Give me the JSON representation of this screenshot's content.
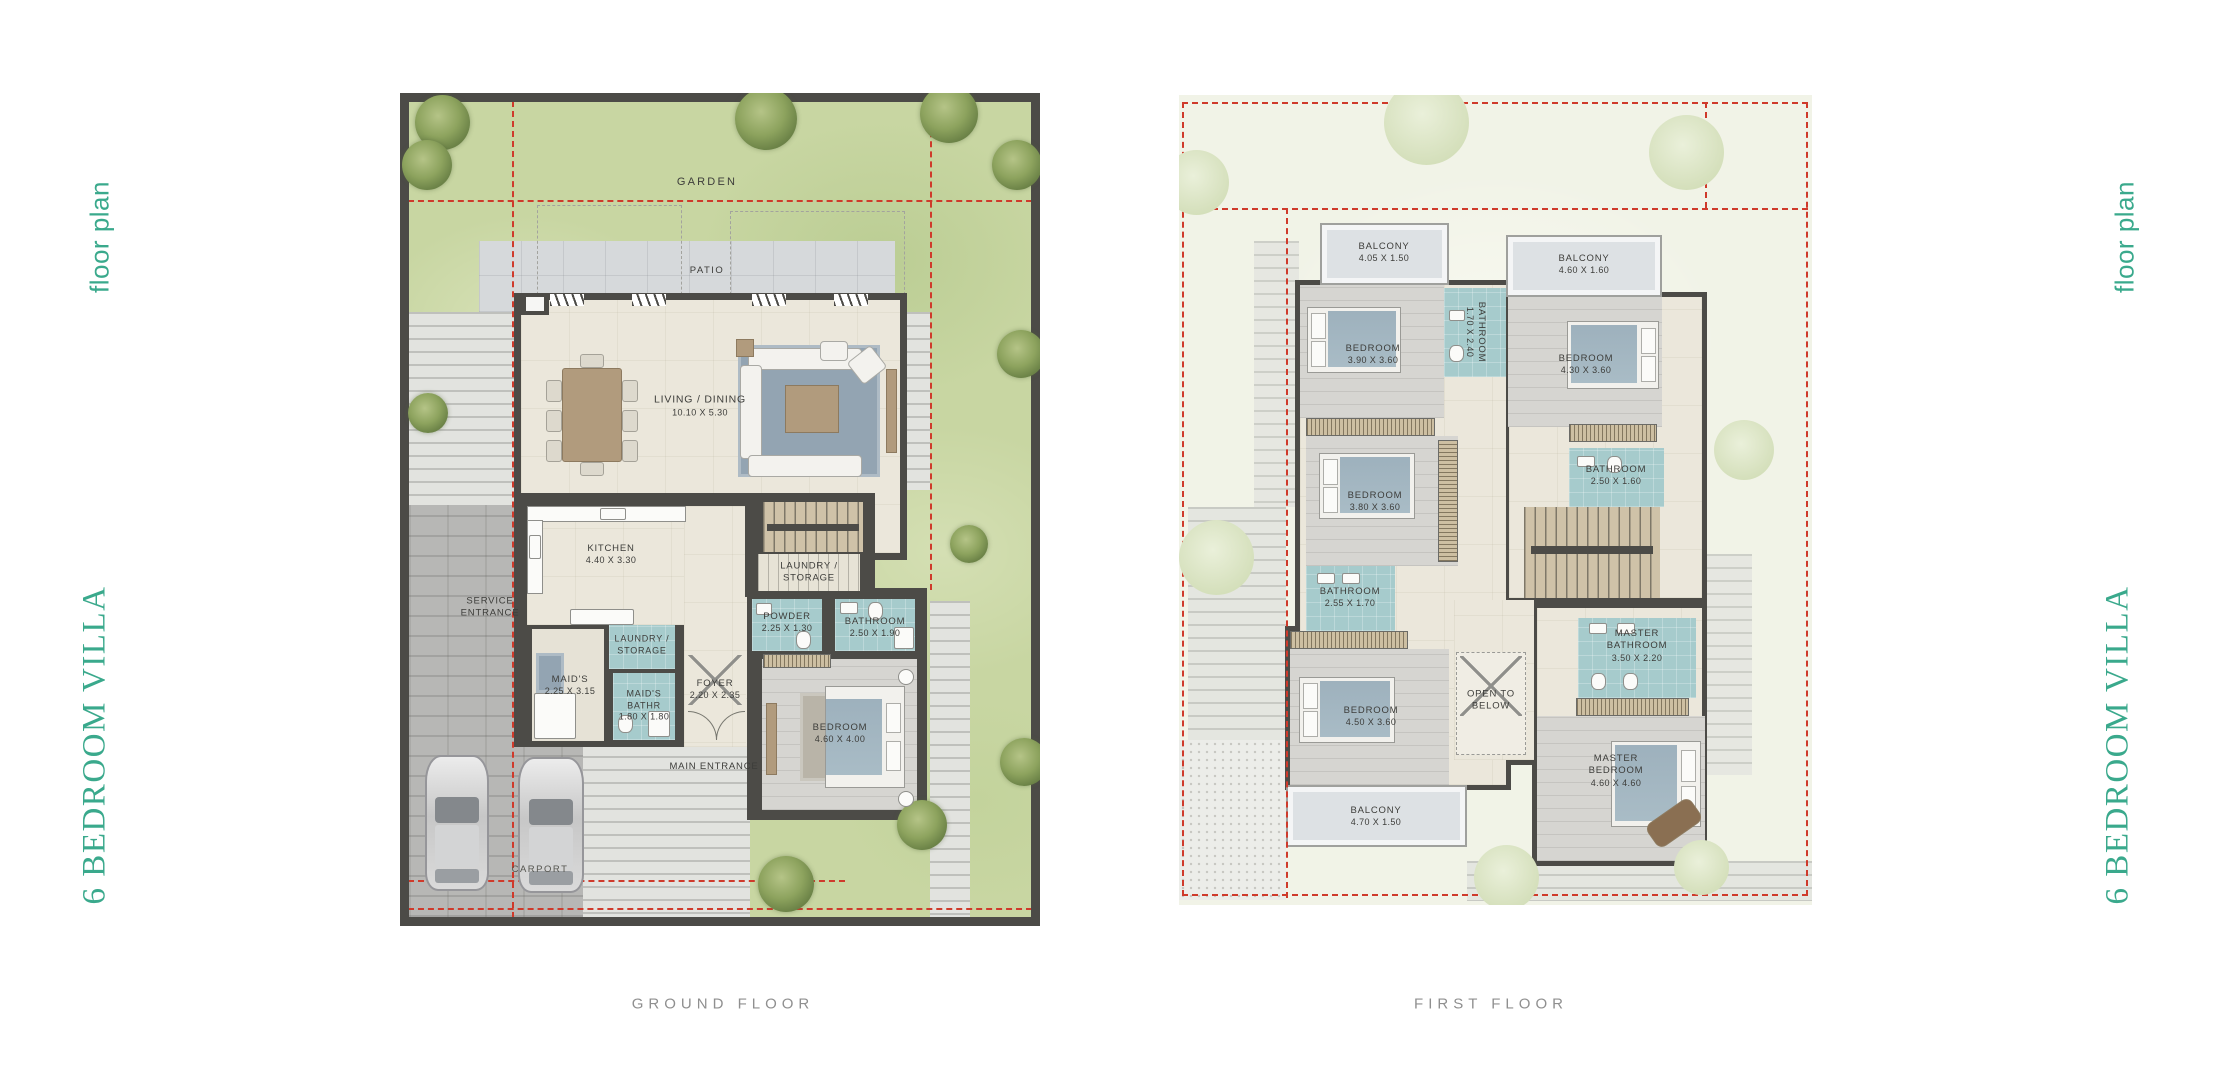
{
  "side": {
    "floor_plan": "floor plan",
    "villa_title": "6 BEDROOM VILLA"
  },
  "captions": {
    "ground": "GROUND FLOOR",
    "first": "FIRST FLOOR"
  },
  "ground": {
    "garden_label": "GARDEN",
    "patio_label": "PATIO",
    "rooms": {
      "living": {
        "name": "LIVING / DINING",
        "dims": "10.10 X 5.30"
      },
      "kitchen": {
        "name": "KITCHEN",
        "dims": "4.40 X 3.30"
      },
      "service_entrance": {
        "name": "SERVICE ENTRANCE",
        "dims": ""
      },
      "laundry_stairs": {
        "name": "LAUNDRY / STORAGE",
        "dims": ""
      },
      "laundry": {
        "name": "LAUNDRY / STORAGE",
        "dims": ""
      },
      "maids": {
        "name": "MAID'S",
        "dims": "2.25 X 3.15"
      },
      "maids_bath": {
        "name": "MAID'S BATHR",
        "dims": "1.80 X 1.80"
      },
      "foyer": {
        "name": "FOYER",
        "dims": "2.20 X 2.35"
      },
      "powder": {
        "name": "POWDER",
        "dims": "2.25 X 1.30"
      },
      "bathroom": {
        "name": "BATHROOM",
        "dims": "2.50 X 1.90"
      },
      "bedroom": {
        "name": "BEDROOM",
        "dims": "4.60 X 4.00"
      },
      "main_entrance": {
        "name": "MAIN ENTRANCE",
        "dims": ""
      },
      "carport": {
        "name": "CARPORT",
        "dims": ""
      }
    }
  },
  "first": {
    "rooms": {
      "balcony_tl": {
        "name": "BALCONY",
        "dims": "4.05 X 1.50"
      },
      "balcony_tr": {
        "name": "BALCONY",
        "dims": "4.60 X 1.60"
      },
      "bedroom_tl": {
        "name": "BEDROOM",
        "dims": "3.90 X 3.60"
      },
      "bathroom_top": {
        "name": "BATHROOM",
        "dims": "1.70 X 2.40"
      },
      "bedroom_tr": {
        "name": "BEDROOM",
        "dims": "4.30 X 3.60"
      },
      "bedroom_ml": {
        "name": "BEDROOM",
        "dims": "3.80 X 3.60"
      },
      "bathroom_mr": {
        "name": "BATHROOM",
        "dims": "2.50 X 1.60"
      },
      "bathroom_ll": {
        "name": "BATHROOM",
        "dims": "2.55 X 1.70"
      },
      "bedroom_ll": {
        "name": "BEDROOM",
        "dims": "4.50 X 3.60"
      },
      "open_below": {
        "name": "OPEN TO BELOW",
        "dims": ""
      },
      "master_bathroom": {
        "name": "MASTER BATHROOM",
        "dims": "3.50 X 2.20"
      },
      "master_bedroom": {
        "name": "MASTER BEDROOM",
        "dims": "4.60 X 4.60"
      },
      "balcony_bl": {
        "name": "BALCONY",
        "dims": "4.70 X 1.50"
      }
    }
  },
  "colors": {
    "accent_teal": "#3aa98c",
    "wall_charcoal": "#4c4b47",
    "plot_line_red": "#cf3a2b",
    "bathroom_teal": "#a6cbcc",
    "garden_green": "#c8d6a2",
    "caption_gray": "#8f8f8f"
  }
}
